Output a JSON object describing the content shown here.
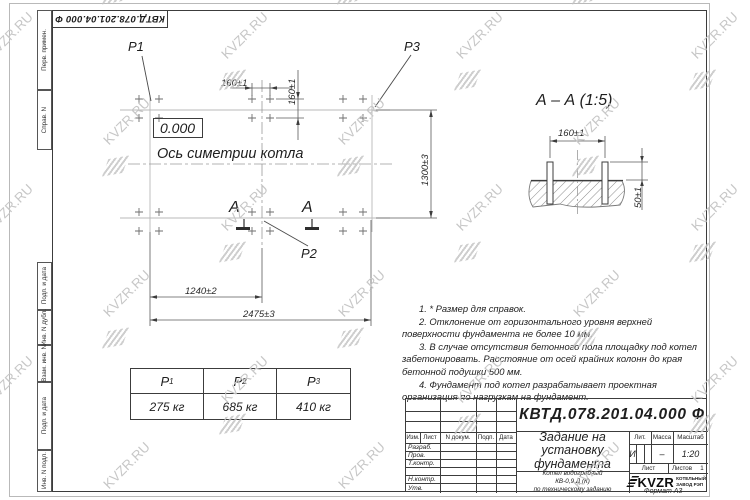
{
  "watermark": {
    "text": "KVZR.RU"
  },
  "corner_stamp": {
    "doc_number": "КВТД.078.201.04.000  Ф"
  },
  "left_margin": {
    "fields": [
      "Перв. примен.",
      "Справ. N",
      "Подп. и дата",
      "Инв. N дубл.",
      "Взам. инв. N",
      "Подп. и дата",
      "Инв. N подл."
    ]
  },
  "plan": {
    "labels": {
      "p1": "P1",
      "p2": "P2",
      "p3": "P3",
      "level": "0.000",
      "axis": "Ось симетрии котла",
      "section_letter_left": "А",
      "section_letter_right": "А"
    },
    "dims": {
      "bolt_pitch_h": "160±1",
      "bolt_pitch_v": "160±1",
      "width": "1300±3",
      "inner_length": "1240±2",
      "outer_length": "2475±3"
    }
  },
  "section": {
    "title": "А – А (1:5)",
    "dim_width": "160±1",
    "dim_height": "50±1"
  },
  "notes": [
    "1. * Размер для справок.",
    "2. Отклонение от горизонтального уровня верхней поверхности фундамента не более 10 мм.",
    "3. В случае отсутствия бетонного пола площадку под котел забетонировать. Расстояние от осей крайних колонн до края бетонной подушки 500 мм.",
    "4. Фундамент под котел разрабатывает проектная организация по нагрузкам на фундамент."
  ],
  "loads_table": {
    "headers": [
      {
        "base": "P",
        "sub": "1"
      },
      {
        "base": "P",
        "sub": "2"
      },
      {
        "base": "P",
        "sub": "3"
      }
    ],
    "values": [
      "275 кг",
      "685 кг",
      "410 кг"
    ]
  },
  "title_block": {
    "doc_number": "КВТД.078.201.04.000  Ф",
    "title": "Задание на\nустановку\nфундамента",
    "product": "Котел водогрейный\nКВ-0,9 Д (К)\nпо техническому заданию",
    "col_headers": {
      "izm": "Изм.",
      "list": "Лист",
      "ndoc": "N докум.",
      "podp": "Подп.",
      "data": "Дата"
    },
    "row_labels": [
      "Разраб.",
      "Пров.",
      "Т.контр.",
      "Н.контр.",
      "Утв."
    ],
    "lit_header": "Лит.",
    "mass_header": "Масса",
    "scale_header": "Масштаб",
    "lit_value": "И",
    "mass_value": "–",
    "scale_value": "1:20",
    "sheet_label": "Лист",
    "sheets_label": "Листов",
    "sheets_value": "1",
    "company": {
      "logo_text": "KVZR",
      "name": "КОТЕЛЬНЫЙ\nЗАВОД РЭП"
    },
    "format": "Формат А3"
  }
}
